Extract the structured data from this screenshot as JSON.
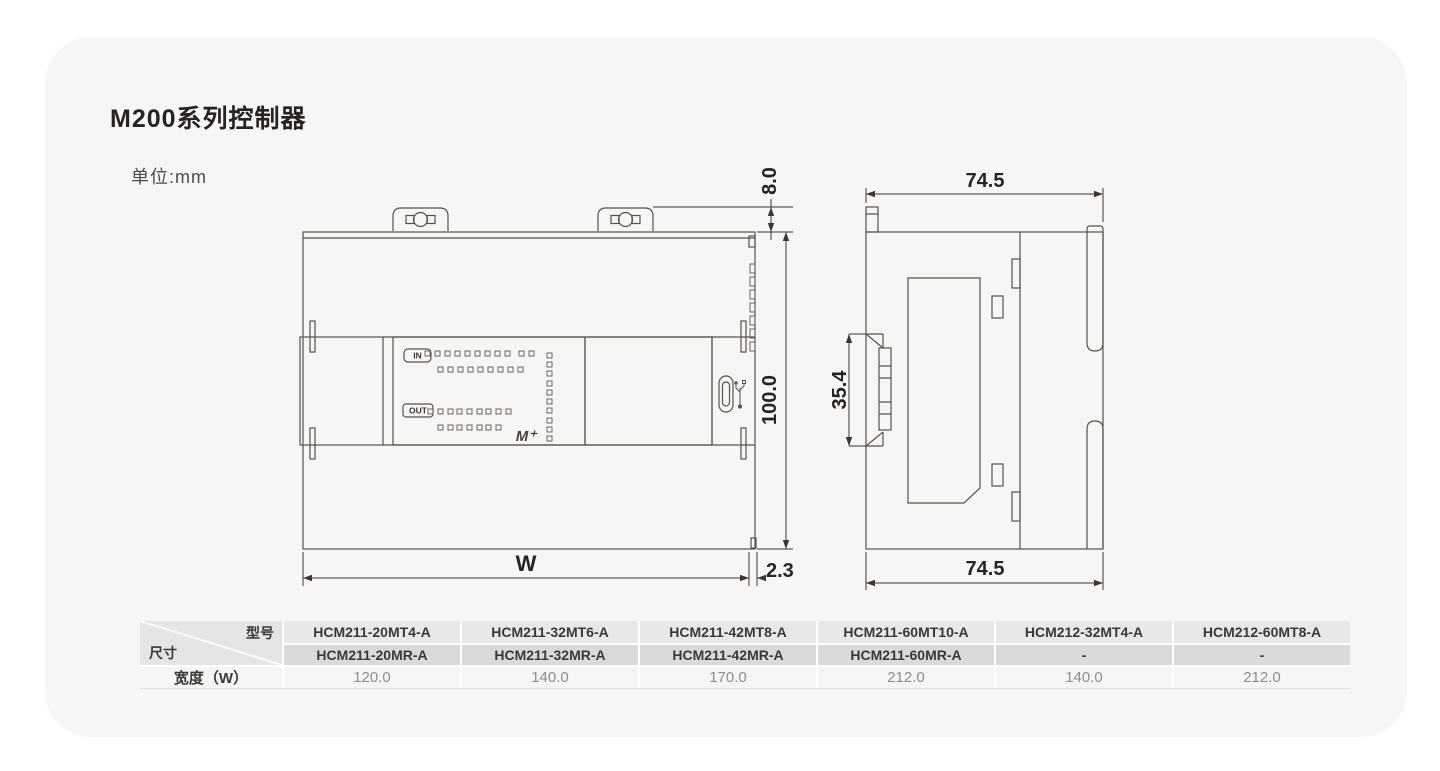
{
  "page": {
    "title": "M200系列控制器",
    "unit_label": "单位:mm"
  },
  "front_view": {
    "in_label": "IN",
    "out_label": "OUT",
    "logo": "M⁺",
    "dims": {
      "tab_height": "8.0",
      "body_height": "100.0",
      "width": "W",
      "offset": "2.3"
    }
  },
  "side_view": {
    "dims": {
      "top_width": "74.5",
      "bottom_width": "74.5",
      "rail_height": "35.4"
    }
  },
  "table": {
    "corner": {
      "top_right": "型号",
      "bottom_left": "尺寸"
    },
    "row_label": "宽度（W）",
    "columns": [
      {
        "line1": "HCM211-20MT4-A",
        "line2": "HCM211-20MR-A",
        "width": "120.0"
      },
      {
        "line1": "HCM211-32MT6-A",
        "line2": "HCM211-32MR-A",
        "width": "140.0"
      },
      {
        "line1": "HCM211-42MT8-A",
        "line2": "HCM211-42MR-A",
        "width": "170.0"
      },
      {
        "line1": "HCM211-60MT10-A",
        "line2": "HCM211-60MR-A",
        "width": "212.0"
      },
      {
        "line1": "HCM212-32MT4-A",
        "line2": "-",
        "width": "140.0"
      },
      {
        "line1": "HCM212-60MT8-A",
        "line2": "-",
        "width": "212.0"
      }
    ]
  },
  "colors": {
    "card_bg": "#f7f6f5",
    "drawing_line": "#57524c",
    "dimension_text": "#272320",
    "table_header_bg_1": "#e9e8e7",
    "table_header_bg_2": "#dbdad9",
    "table_row_bg": "#f6f5f4",
    "table_value_text": "#908d8a"
  }
}
